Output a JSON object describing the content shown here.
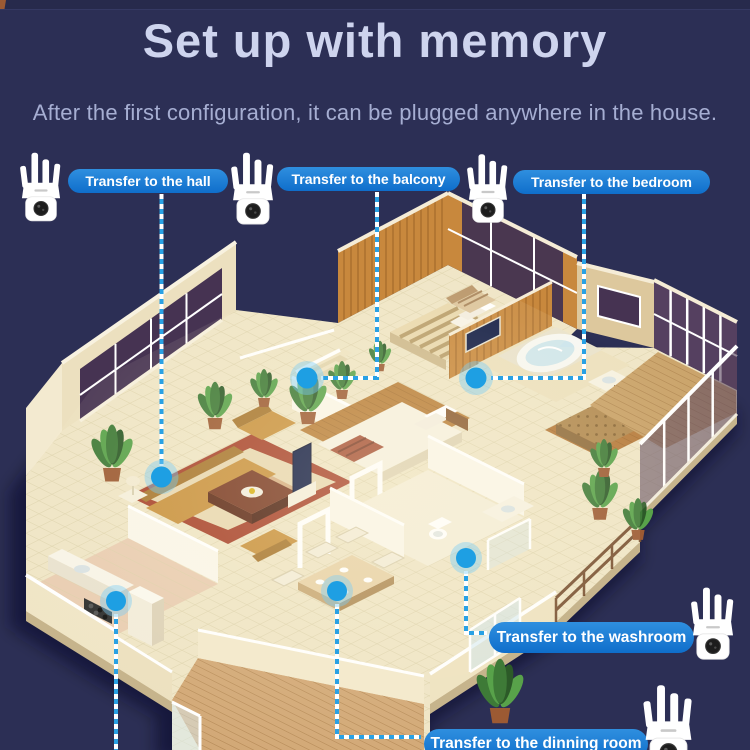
{
  "header": {
    "title": "Set up with memory",
    "subtitle": "After the first configuration, it can be plugged anywhere in the house."
  },
  "callouts": {
    "hall": {
      "label": "Transfer to the hall"
    },
    "balcony": {
      "label": "Transfer to the balcony"
    },
    "bedroom": {
      "label": "Transfer to the bedroom"
    },
    "washroom": {
      "label": "Transfer to the washroom"
    },
    "dinning": {
      "label": "Transfer to the dinning room"
    }
  },
  "icons": {
    "repeater": "wifi-repeater-device",
    "placement_marker": "placement-dot"
  },
  "colors": {
    "background": "#2c2f55",
    "pill_blue": "#1878d2",
    "pill_text": "#ffffff",
    "dot_blue": "#29a1e4",
    "leader_line_blue": "#29a1e4",
    "leader_line_white": "#ffffff",
    "title_text": "#ced4ee",
    "subtitle_text": "#a6aed2"
  }
}
